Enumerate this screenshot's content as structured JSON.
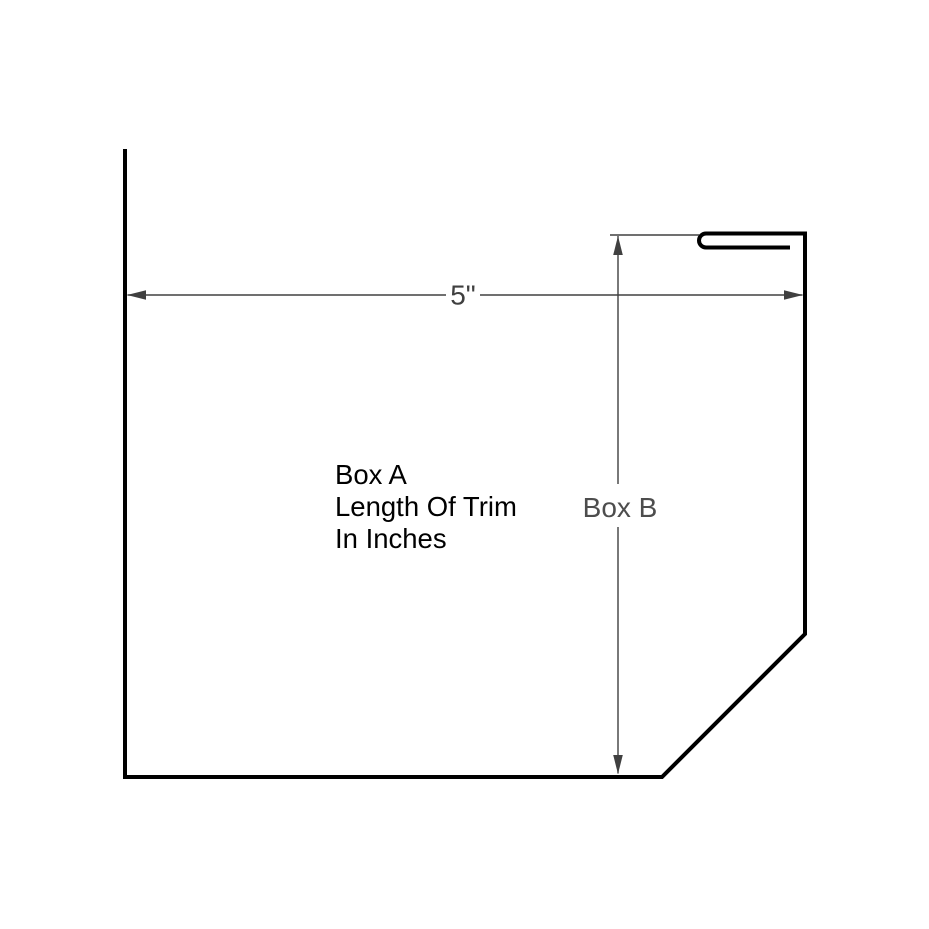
{
  "diagram": {
    "labels": {
      "width_dim": "5\"",
      "height_dim": "Box B",
      "note_line1": "Box A",
      "note_line2": "Length Of Trim",
      "note_line3": "In Inches"
    },
    "colors": {
      "profile_stroke": "#000000",
      "dimension_stroke": "#404040",
      "note_text": "#000000",
      "width_label_text": "#404040",
      "height_label_text": "#4d4d4d",
      "background": "#ffffff"
    }
  }
}
